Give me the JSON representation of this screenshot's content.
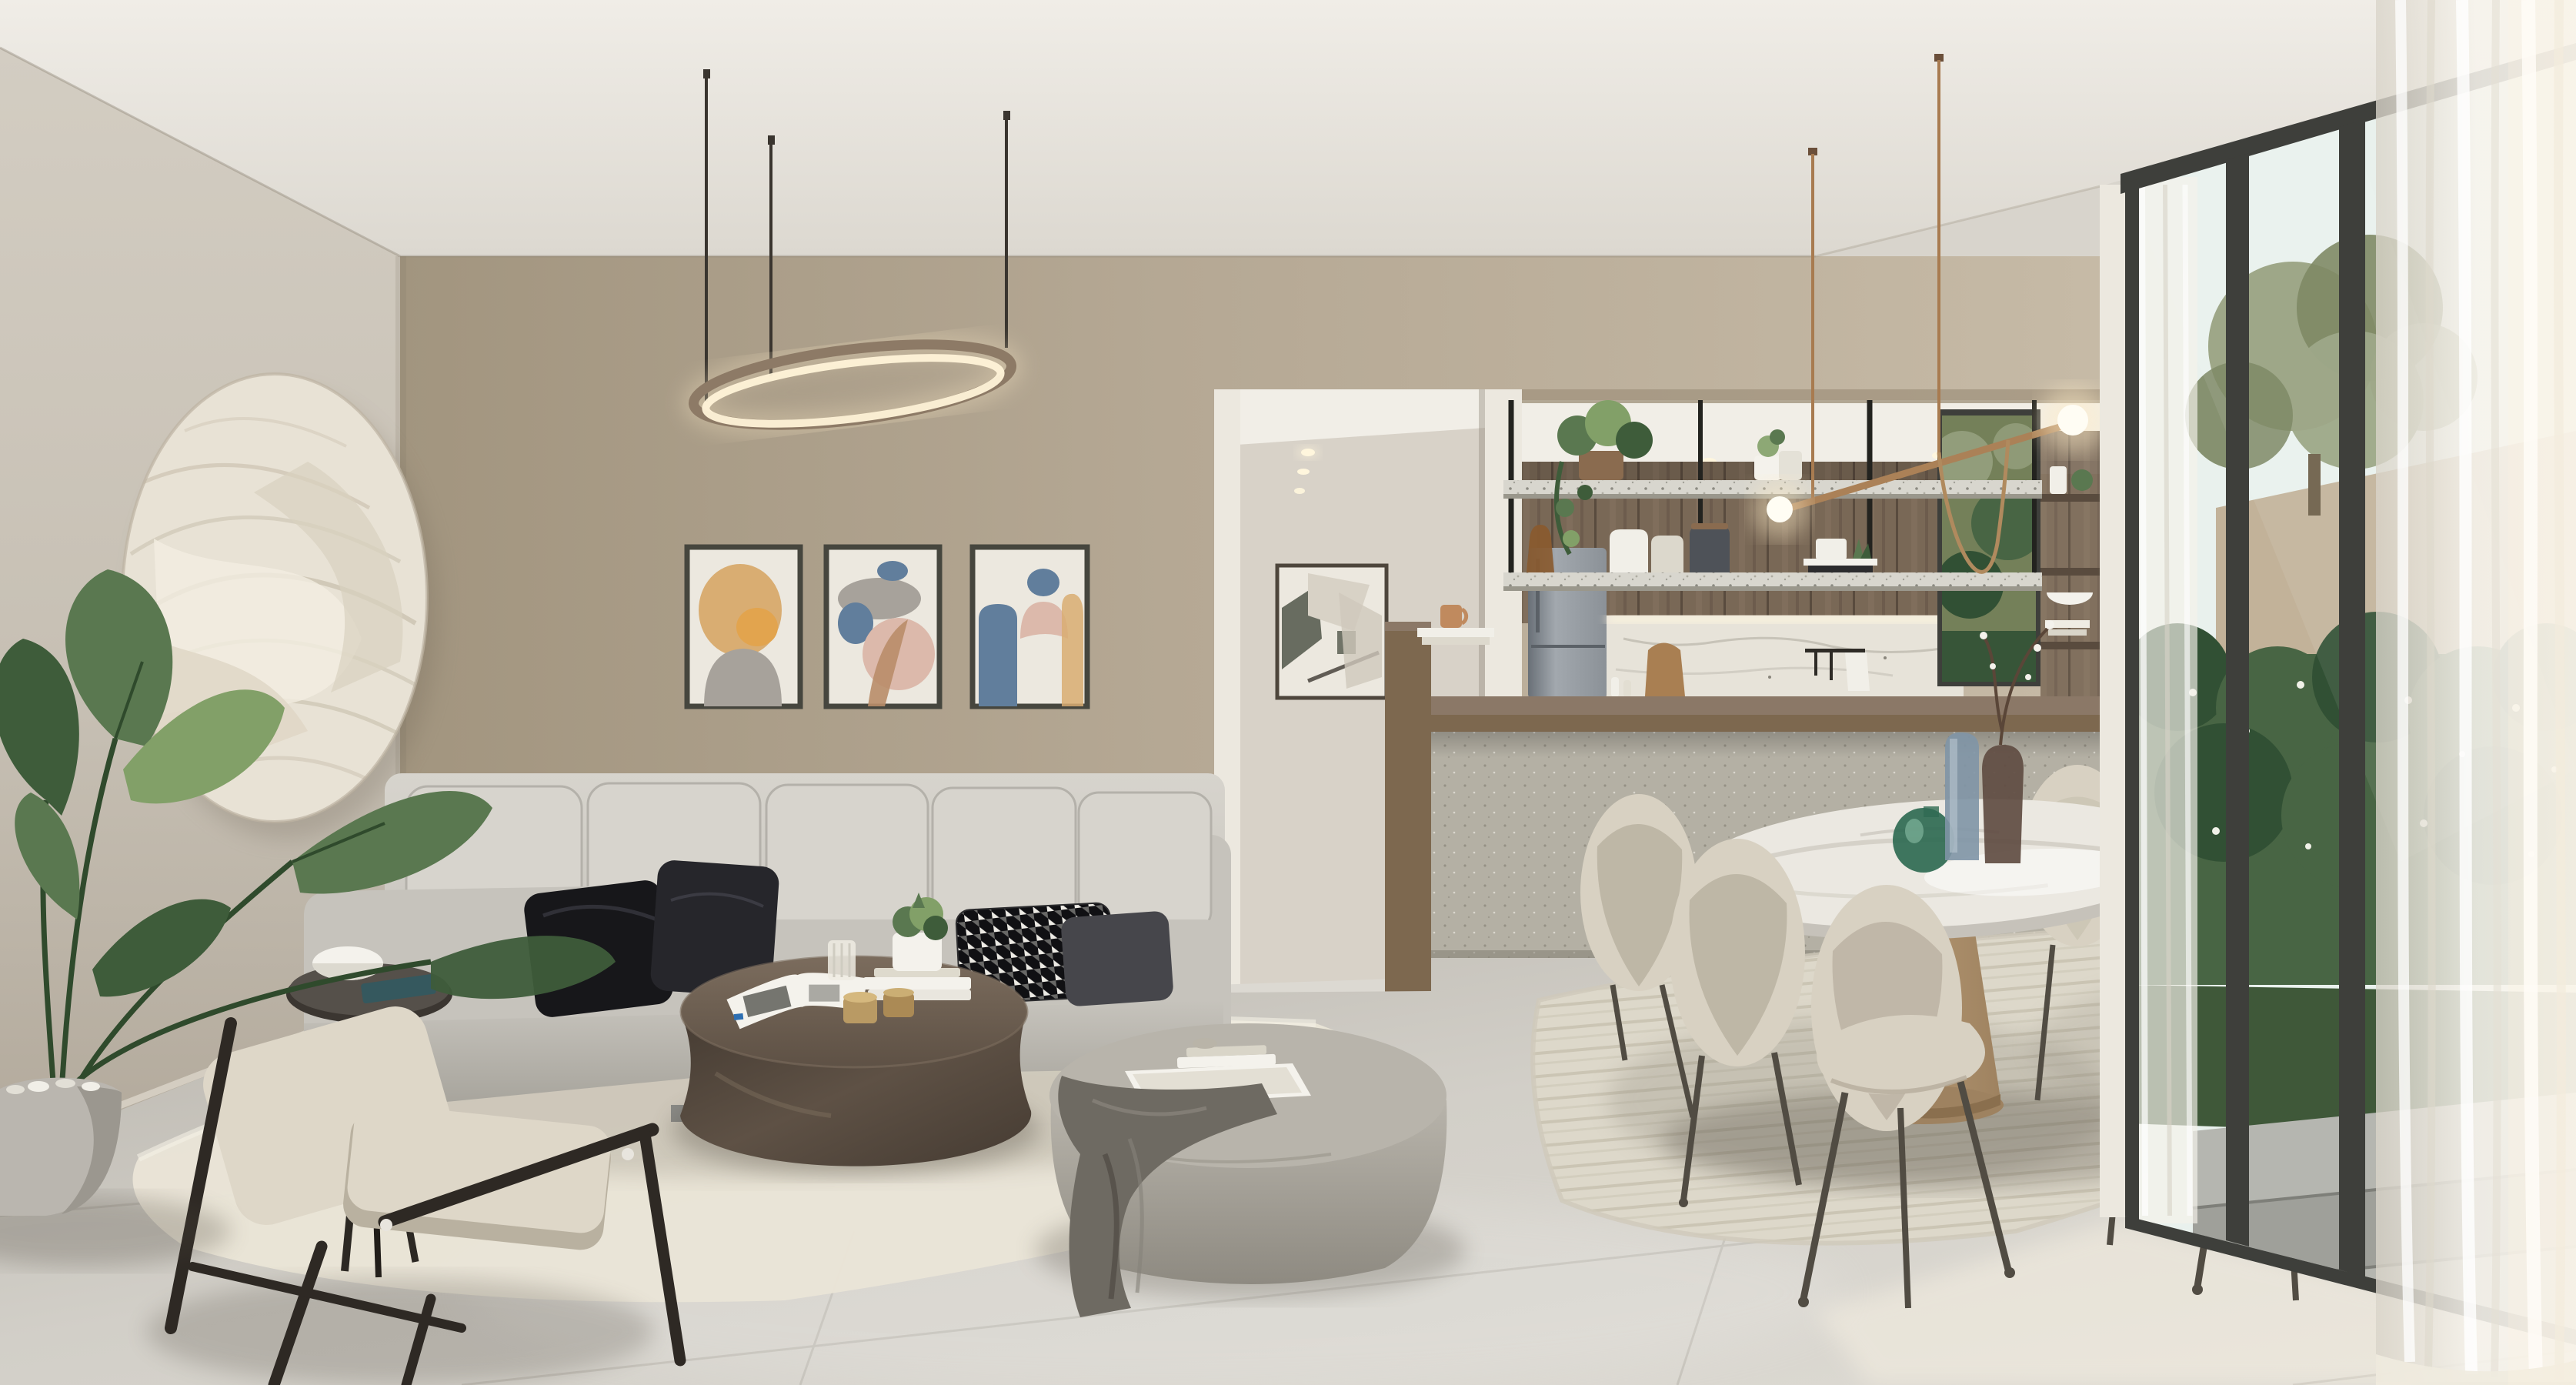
{
  "scene": {
    "type": "interior-architectural-render",
    "room": "open-plan living room with kitchen and dining area",
    "objects": [
      "ceiling",
      "left-wall",
      "back-wall",
      "circular-relief-wall-art",
      "potted-bird-of-paradise-plant",
      "linear-oval-pendant-light",
      "gallery-of-three-abstract-prints",
      "grey-sectional-sofa",
      "black-velvet-pillows",
      "houndstooth-pillow",
      "charcoal-pillow",
      "bronze-oval-coffee-table",
      "open-magazine",
      "book-stack",
      "succulent-in-white-pot",
      "glass-cup",
      "gold-candles",
      "black-round-side-table",
      "white-bowl",
      "wood-frame-armchair",
      "round-fabric-pouf",
      "white-tray-with-books",
      "draped-throw-blanket",
      "cream-area-rug",
      "hallway-opening",
      "hallway-abstract-art",
      "recessed-spotlights",
      "kitchen-wood-cabinets",
      "grey-refrigerator",
      "marble-backsplash",
      "suspended-terrazzo-shelves",
      "trailing-plants",
      "canister-set",
      "brass-linear-pendant-with-globes",
      "kitchen-window-greenery",
      "kitchen-island",
      "wood-countertop",
      "bar-end-panel-with-mug-and-books",
      "oval-marble-dining-table",
      "wood-pedestal-base",
      "green-glass-vase",
      "blue-glass-vase",
      "smoked-glass-vase-with-blossoms",
      "six-cream-velvet-dining-chairs",
      "ribbed-dining-rug",
      "floor-to-ceiling-window",
      "window-mullions",
      "sheer-curtains",
      "olive-tree",
      "flowering-shrubs",
      "garden-wall",
      "stone-steps",
      "tiled-concrete-floor"
    ],
    "palette": {
      "ceiling-hi": "#f0ede7",
      "ceiling-lo": "#dcd8d0",
      "wall-back-l": "#c6baa6",
      "wall-back": "#b5a894",
      "wall-back-d": "#a2957f",
      "wall-left-hi": "#d3cdc2",
      "wall-left": "#c6bfb3",
      "wall-left-d": "#b2a99b",
      "wall-pillar": "#ece8df",
      "hall-wall": "#d8d2c8",
      "hall-ceiling": "#f1eee7",
      "hall-floor": "#dcd9d2",
      "floor-hi": "#dedbd4",
      "floor": "#d2cfc8",
      "floor-d": "#b9b5ad",
      "grout": "#8f8a80",
      "rug-living": "#e9e4d7",
      "rug-dining": "#ddd8ca",
      "rug-rib": "#c9c3b2",
      "sofa-hi": "#d7d4cd",
      "sofa": "#c6c3bc",
      "sofa-d": "#a4a199",
      "pillow-black": "#17171a",
      "pillow-black2": "#26262b",
      "pillow-charcoal": "#46464b",
      "hound-dark": "#101013",
      "hound-light": "#eceae4",
      "bronze-hi": "#7b6c5d",
      "bronze": "#5e5145",
      "bronze-d": "#453b32",
      "pouf-hi": "#b8b4ab",
      "pouf": "#a9a59c",
      "pouf-d": "#8e8a81",
      "throw": "#6e6a62",
      "throw-d": "#524e47",
      "chair-frame": "#2e2924",
      "cushion-cream": "#ded7c8",
      "cushion-shade": "#b9b1a0",
      "side-table": "#3b3631",
      "magazine-teal": "#35585e",
      "wood-hi": "#8b7867",
      "wood": "#796856",
      "wood-d": "#594b3e",
      "counter-wood": "#7d684f",
      "island": "#b4b0a4",
      "island-d": "#9c988c",
      "fridge-hi": "#a2a8ae",
      "fridge": "#8b9197",
      "fridge-d": "#697077",
      "backsplash": "#e7e3d9",
      "terrazzo": "#d8d6ce",
      "shelf-frame": "#23231f",
      "brass": "#ab8157",
      "copper": "#a87b50",
      "glow": "#ffedc8",
      "marble": "#ebe8e1",
      "marble-vein": "#c6c2ba",
      "ped-wood": "#c2a47c",
      "ped-wood-d": "#9e8260",
      "glass-frame": "#3e3f3b",
      "sky": "#e9f1ed",
      "olive": "#96a07e",
      "olive-d": "#748059",
      "bush": "#486544",
      "bush-d": "#315034",
      "garden-wall": "#c2b299",
      "grass": "#3f5839",
      "paver": "#b5b6b0",
      "paver-d": "#9fa09a",
      "curtain": "#f7f4ed",
      "curtain-shade": "#d9d4c9",
      "velvet-chair": "#d8d1c2",
      "velvet-shade": "#b6ad9c",
      "chair-leg": "#514c43",
      "plant": "#5a7850",
      "plant-d": "#3e5c3a",
      "plant-l": "#82a068",
      "pot": "#bab6af",
      "pot-d": "#9b978f",
      "circle-art": "#e8e2d5",
      "circle-ridge": "#cfc7b5",
      "art-cream": "#ece8df",
      "art-tan": "#d9ad72",
      "art-orange": "#e2a44e",
      "art-grey": "#a7a29b",
      "art-blue": "#617e9c",
      "art-pink": "#dcb9ab",
      "art-brown": "#b98d69",
      "art-olive": "#5a5e52",
      "glass-green": "#2f6a52",
      "glass-blue": "#8095a6",
      "glass-smoke": "#5f4c42",
      "white": "#f4f2ec",
      "mug": "#c08a5e",
      "metal": "#8a8a86",
      "pendant-rim": "#8d7a66"
    }
  }
}
